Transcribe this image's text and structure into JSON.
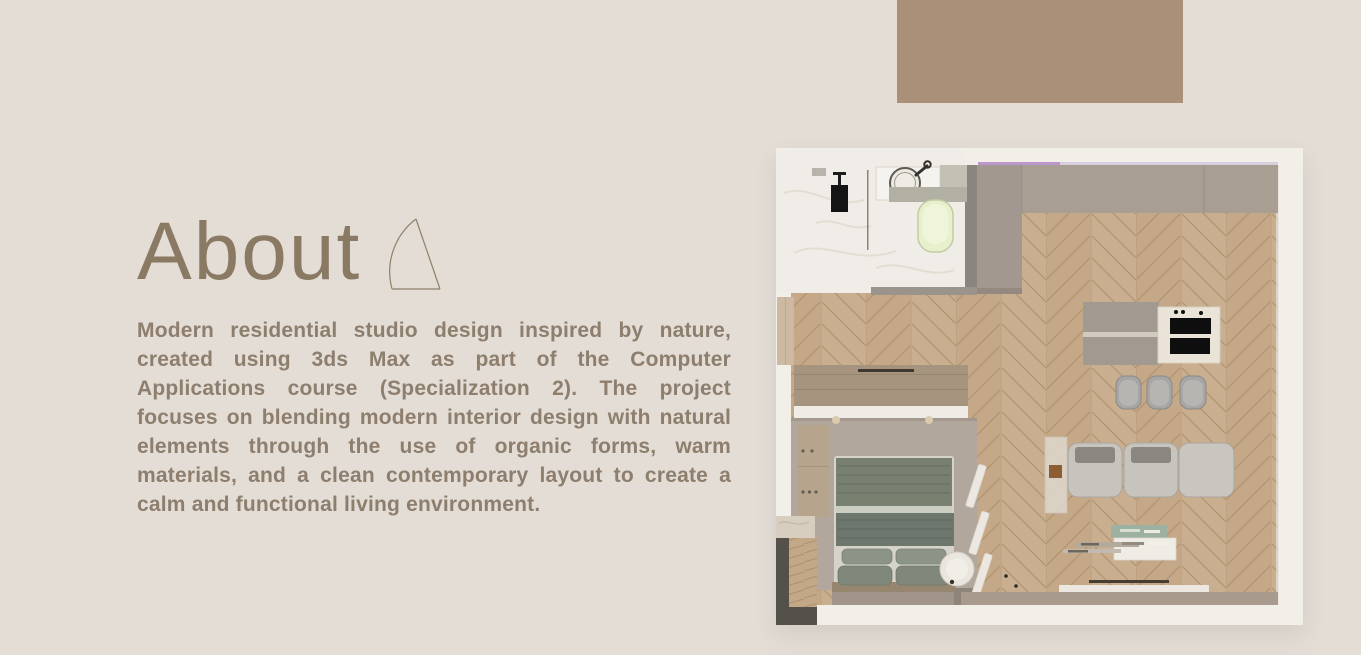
{
  "page": {
    "background_color": "#e3ddd6",
    "accent_block_color": "#aa9078"
  },
  "about": {
    "title": "About",
    "title_color": "#8a7a63",
    "body_color": "#8d7e6d",
    "paragraph": "Modern residential studio design inspired by nature, created using 3ds Max as part of the Computer Applications course (Specialization 2). The project focuses on blending modern interior design with natural elements through the use of organic forms, warm materials, and a clean contemporary layout to create a calm and functional living environment."
  },
  "floor_plan": {
    "description": "Top-down 3D rendering of a residential studio floor plan",
    "rooms": [
      {
        "name": "bathroom",
        "features": [
          "shower-head",
          "glass-divider",
          "round-sink-vanity",
          "corner-counter",
          "toilet"
        ]
      },
      {
        "name": "kitchen",
        "features": [
          "wall-counter",
          "tall-cabinet-column",
          "island-with-cooktop",
          "three-bar-stools"
        ]
      },
      {
        "name": "living-area",
        "features": [
          "three-seat-sofa",
          "glass-side-console",
          "media-shelf",
          "wall-tv",
          "window-sill"
        ]
      },
      {
        "name": "bedroom",
        "features": [
          "double-bed",
          "four-pillows",
          "wardrobe",
          "tv-cabinet",
          "round-bedside-table",
          "slat-screen",
          "entry-closet"
        ]
      }
    ],
    "colors": {
      "wood_floor": "#c9ae8f",
      "wall_band": "#a89b8d",
      "dark_wall": "#8a857f",
      "bathroom_floor": "#f0ece7",
      "bedroom_carpet": "#b2a79d",
      "bed_duvet": "#78816f",
      "pillow": "#7f887b",
      "sofa": "#c7c3bd",
      "sofa_backrest": "#8a8781",
      "toilet": "#e7efcb",
      "accent_line": "#bb97cc",
      "closet_dark": "#54514b"
    }
  }
}
